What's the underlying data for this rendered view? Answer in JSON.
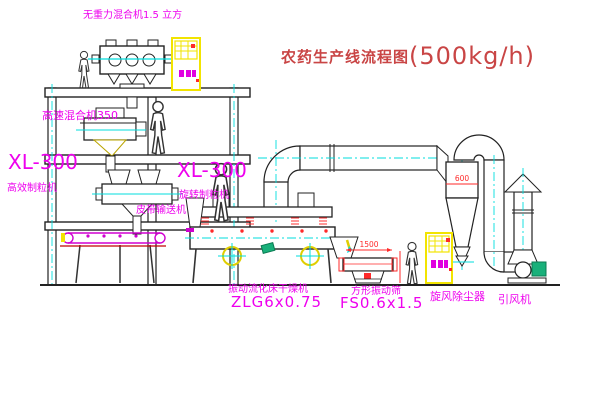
{
  "title": {
    "name": "农药生产线流程图",
    "capacity": "(500kg/h)"
  },
  "labels": {
    "gravity_mixer": "无重力混合机1.5 立方",
    "speed_mixer": "高速混合机350",
    "granulator_left_model": "XL-300",
    "granulator_left_name": "高效制粒机",
    "granulator_mid_model": "XL-300",
    "granulator_mid_name": "旋转制粒机",
    "belt_conveyor": "皮带输送机",
    "dryer_name": "振动流化床干燥机",
    "dryer_model": "ZLG6x0.75",
    "sieve_name": "方形振动筛",
    "sieve_model": "FS0.6x1.5",
    "cyclone_name": "旋风除尘器",
    "fan_name": "引风机"
  },
  "dimensions": {
    "sieve_length": "1500",
    "cyclone_diameter": "600"
  },
  "colors": {
    "label_magenta": "#EE00EE",
    "title_red": "#C94545",
    "centerline_cyan": "#00DEDE",
    "cabinet_yellow": "#F2E400",
    "dimension_red": "#FF2A2A",
    "machine_green": "#19B07A"
  }
}
